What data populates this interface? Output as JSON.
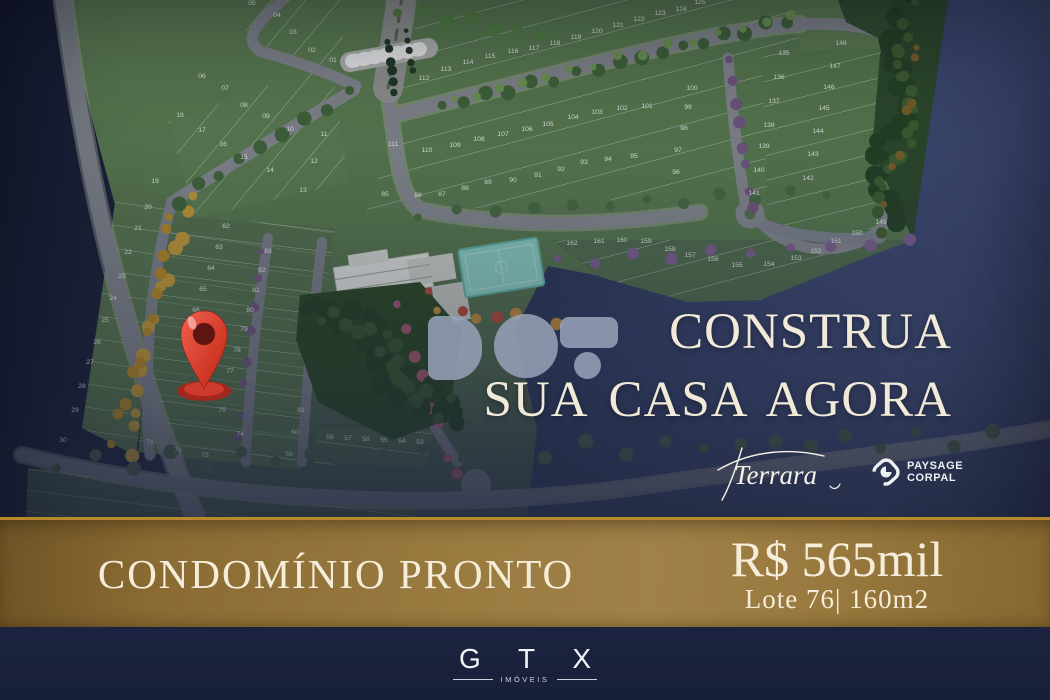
{
  "headline": {
    "line1": "CONSTRUA",
    "line2": "SUA CASA AGORA"
  },
  "brand_script": "Terrara",
  "partner_logo": {
    "line1": "PAYSAGE",
    "line2": "CORPAL"
  },
  "banner": {
    "status": "CONDOMÍNIO PRONTO",
    "price": "R$ 565mil",
    "lot": "Lote 76| 160m2"
  },
  "footer": {
    "brand": "G T X",
    "division": "IMÓVEIS"
  },
  "colors": {
    "cream": "#f2ebd9",
    "gold": "#9a7b40",
    "gold_edge": "#b9892e",
    "navy_dark": "#11172a",
    "navy_light": "#3d4970",
    "footer_navy": "#1b2238",
    "pin_red": "#d93a28",
    "lot_green": "#5d7f4e",
    "road_gray": "#85888c",
    "court_teal": "#8ccfc0"
  },
  "map": {
    "lots": [
      [
        "01",
        333,
        62
      ],
      [
        "02",
        312,
        52
      ],
      [
        "03",
        293,
        34
      ],
      [
        "04",
        277,
        17
      ],
      [
        "05",
        252,
        5
      ],
      [
        "06",
        202,
        78
      ],
      [
        "07",
        225,
        90
      ],
      [
        "08",
        244,
        107
      ],
      [
        "09",
        266,
        118
      ],
      [
        "10",
        290,
        131
      ],
      [
        "11",
        324,
        136
      ],
      [
        "12",
        314,
        163
      ],
      [
        "13",
        303,
        192
      ],
      [
        "14",
        270,
        172
      ],
      [
        "15",
        244,
        159
      ],
      [
        "16",
        223,
        146
      ],
      [
        "17",
        202,
        132
      ],
      [
        "18",
        180,
        117
      ],
      [
        "19",
        155,
        183
      ],
      [
        "20",
        148,
        209
      ],
      [
        "21",
        138,
        230
      ],
      [
        "22",
        128,
        254
      ],
      [
        "23",
        122,
        278
      ],
      [
        "24",
        113,
        300
      ],
      [
        "25",
        105,
        322
      ],
      [
        "26",
        97,
        344
      ],
      [
        "27",
        90,
        364
      ],
      [
        "28",
        82,
        388
      ],
      [
        "29",
        75,
        412
      ],
      [
        "30",
        63,
        442
      ],
      [
        "62",
        226,
        228
      ],
      [
        "63",
        219,
        249
      ],
      [
        "64",
        211,
        270
      ],
      [
        "65",
        203,
        291
      ],
      [
        "66",
        196,
        312
      ],
      [
        "83",
        268,
        253
      ],
      [
        "82",
        262,
        272
      ],
      [
        "81",
        256,
        292
      ],
      [
        "80",
        250,
        312
      ],
      [
        "79",
        244,
        331
      ],
      [
        "78",
        237,
        352
      ],
      [
        "77",
        230,
        373
      ],
      [
        "75",
        222,
        412
      ],
      [
        "74",
        240,
        436
      ],
      [
        "73",
        205,
        457
      ],
      [
        "72",
        178,
        452
      ],
      [
        "71",
        150,
        444
      ],
      [
        "61",
        301,
        412
      ],
      [
        "60",
        295,
        434
      ],
      [
        "59",
        289,
        456
      ],
      [
        "53",
        420,
        444
      ],
      [
        "54",
        402,
        443
      ],
      [
        "55",
        384,
        442
      ],
      [
        "56",
        330,
        439
      ],
      [
        "57",
        348,
        440
      ],
      [
        "58",
        366,
        441
      ],
      [
        "85",
        385,
        196
      ],
      [
        "86",
        418,
        197
      ],
      [
        "87",
        442,
        196
      ],
      [
        "88",
        465,
        190
      ],
      [
        "89",
        488,
        184
      ],
      [
        "90",
        513,
        182
      ],
      [
        "91",
        538,
        177
      ],
      [
        "92",
        561,
        171
      ],
      [
        "93",
        584,
        164
      ],
      [
        "94",
        608,
        161
      ],
      [
        "95",
        634,
        158
      ],
      [
        "96",
        676,
        174
      ],
      [
        "97",
        678,
        152
      ],
      [
        "98",
        684,
        130
      ],
      [
        "99",
        688,
        109
      ],
      [
        "100",
        692,
        90
      ],
      [
        "101",
        647,
        108
      ],
      [
        "102",
        622,
        110
      ],
      [
        "103",
        597,
        114
      ],
      [
        "104",
        573,
        119
      ],
      [
        "105",
        548,
        126
      ],
      [
        "106",
        527,
        131
      ],
      [
        "107",
        503,
        136
      ],
      [
        "108",
        479,
        141
      ],
      [
        "109",
        455,
        147
      ],
      [
        "110",
        427,
        152
      ],
      [
        "111",
        393,
        146
      ],
      [
        "112",
        424,
        80
      ],
      [
        "113",
        446,
        71
      ],
      [
        "114",
        468,
        64
      ],
      [
        "115",
        490,
        58
      ],
      [
        "116",
        513,
        53
      ],
      [
        "117",
        534,
        50
      ],
      [
        "118",
        555,
        45
      ],
      [
        "119",
        576,
        39
      ],
      [
        "120",
        597,
        33
      ],
      [
        "121",
        618,
        27
      ],
      [
        "122",
        639,
        21
      ],
      [
        "123",
        660,
        15
      ],
      [
        "124",
        681,
        11
      ],
      [
        "125",
        700,
        4
      ],
      [
        "135",
        784,
        55
      ],
      [
        "136",
        779,
        79
      ],
      [
        "137",
        774,
        103
      ],
      [
        "138",
        769,
        127
      ],
      [
        "139",
        764,
        148
      ],
      [
        "140",
        759,
        172
      ],
      [
        "141",
        754,
        195
      ],
      [
        "142",
        808,
        180
      ],
      [
        "143",
        813,
        156
      ],
      [
        "144",
        818,
        133
      ],
      [
        "145",
        824,
        110
      ],
      [
        "146",
        829,
        89
      ],
      [
        "147",
        835,
        68
      ],
      [
        "148",
        841,
        45
      ],
      [
        "149",
        881,
        224
      ],
      [
        "150",
        857,
        235
      ],
      [
        "151",
        836,
        243
      ],
      [
        "152",
        816,
        253
      ],
      [
        "153",
        796,
        260
      ],
      [
        "154",
        769,
        266
      ],
      [
        "155",
        737,
        267
      ],
      [
        "156",
        713,
        261
      ],
      [
        "157",
        690,
        257
      ],
      [
        "158",
        670,
        251
      ],
      [
        "159",
        646,
        243
      ],
      [
        "160",
        622,
        242
      ],
      [
        "161",
        599,
        243
      ],
      [
        "162",
        572,
        245
      ]
    ],
    "tree_rows": [
      {
        "name": "yellow-left",
        "color": "#c49a33",
        "x1": 186,
        "y1": 195,
        "x2": 128,
        "y2": 450,
        "count": 14,
        "r": 6,
        "jitter": 7
      },
      {
        "name": "yellow-left-2",
        "color": "#b8891f",
        "x1": 172,
        "y1": 212,
        "x2": 116,
        "y2": 440,
        "count": 12,
        "r": 5,
        "jitter": 6
      },
      {
        "name": "avenue-green",
        "color": "#3f6436",
        "x1": 445,
        "y1": 106,
        "x2": 790,
        "y2": 20,
        "count": 17,
        "r": 6,
        "jitter": 3
      },
      {
        "name": "avenue-green-light",
        "color": "#6f9850",
        "x1": 452,
        "y1": 101,
        "x2": 788,
        "y2": 16,
        "count": 15,
        "r": 4,
        "jitter": 3
      },
      {
        "name": "entry-diagonal-green",
        "color": "#3f6436",
        "x1": 348,
        "y1": 94,
        "x2": 180,
        "y2": 200,
        "count": 9,
        "r": 6,
        "jitter": 4
      },
      {
        "name": "mid-road-green",
        "color": "#46693c",
        "x1": 420,
        "y1": 214,
        "x2": 830,
        "y2": 192,
        "count": 12,
        "r": 5,
        "jitter": 4
      },
      {
        "name": "bottom-road-green",
        "color": "#4a5e45",
        "x1": 50,
        "y1": 463,
        "x2": 1000,
        "y2": 438,
        "count": 26,
        "r": 6,
        "jitter": 8
      },
      {
        "name": "purple-column",
        "color": "#70557e",
        "x1": 726,
        "y1": 60,
        "x2": 756,
        "y2": 210,
        "count": 8,
        "r": 5,
        "jitter": 3
      },
      {
        "name": "purple-band",
        "color": "#7d5f8d",
        "x1": 560,
        "y1": 262,
        "x2": 906,
        "y2": 242,
        "count": 10,
        "r": 5,
        "jitter": 4
      },
      {
        "name": "purple-mid-column",
        "color": "#70557e",
        "x1": 258,
        "y1": 252,
        "x2": 240,
        "y2": 440,
        "count": 8,
        "r": 4,
        "jitter": 3
      },
      {
        "name": "pink-culdesac",
        "color": "#a2566b",
        "x1": 392,
        "y1": 305,
        "x2": 462,
        "y2": 478,
        "count": 8,
        "r": 5,
        "jitter": 5
      },
      {
        "name": "forest-right-dark",
        "color": "#223f1f",
        "x1": 905,
        "y1": 10,
        "x2": 882,
        "y2": 225,
        "count": 28,
        "r": 8,
        "jitter": 14
      },
      {
        "name": "forest-right-mid",
        "color": "#3c5c2b",
        "x1": 915,
        "y1": 15,
        "x2": 888,
        "y2": 220,
        "count": 22,
        "r": 5,
        "jitter": 13
      },
      {
        "name": "forest-right-autumn",
        "color": "#7a5f23",
        "x1": 910,
        "y1": 40,
        "x2": 885,
        "y2": 200,
        "count": 7,
        "r": 4,
        "jitter": 10
      },
      {
        "name": "forest-center-dark",
        "color": "#223f1f",
        "x1": 322,
        "y1": 302,
        "x2": 445,
        "y2": 418,
        "count": 24,
        "r": 9,
        "jitter": 16
      },
      {
        "name": "forest-center-mid",
        "color": "#35542a",
        "x1": 332,
        "y1": 312,
        "x2": 450,
        "y2": 412,
        "count": 18,
        "r": 6,
        "jitter": 14
      },
      {
        "name": "amenity-red-trees",
        "color": "#b04a33",
        "x1": 428,
        "y1": 295,
        "x2": 500,
        "y2": 320,
        "count": 3,
        "r": 5,
        "jitter": 4
      },
      {
        "name": "amenity-orange-trees",
        "color": "#c08a35",
        "x1": 440,
        "y1": 313,
        "x2": 560,
        "y2": 320,
        "count": 4,
        "r": 5,
        "jitter": 4
      },
      {
        "name": "top-edge-green",
        "color": "#54823f",
        "x1": 395,
        "y1": 10,
        "x2": 540,
        "y2": 34,
        "count": 7,
        "r": 6,
        "jitter": 4
      },
      {
        "name": "entrance-hedge",
        "color": "#1e3520",
        "x1": 388,
        "y1": 40,
        "x2": 392,
        "y2": 92,
        "count": 6,
        "r": 4,
        "jitter": 2
      },
      {
        "name": "entrance-hedge-2",
        "color": "#22391f",
        "x1": 408,
        "y1": 30,
        "x2": 412,
        "y2": 72,
        "count": 5,
        "r": 3,
        "jitter": 2
      }
    ]
  }
}
